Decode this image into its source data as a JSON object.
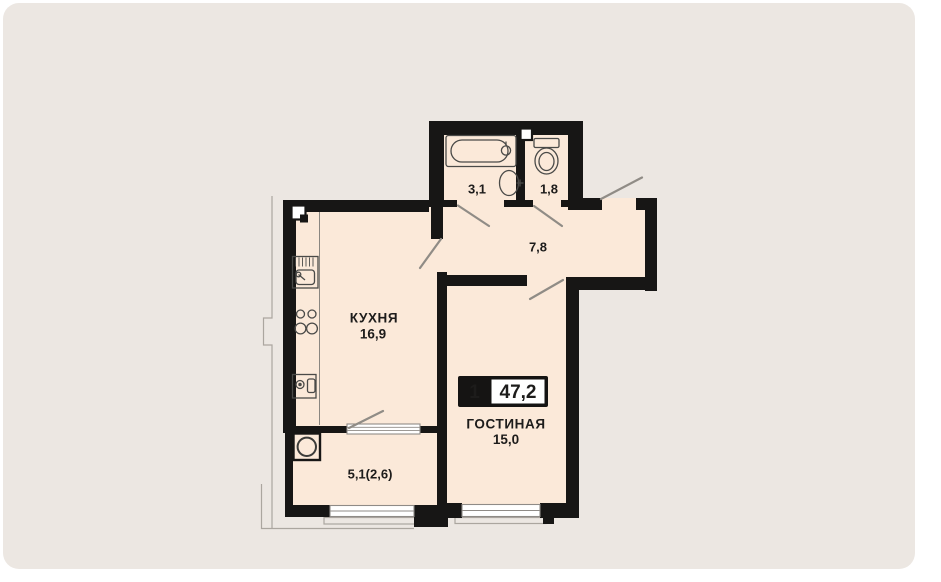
{
  "badge": {
    "rooms_count": "1",
    "total_area": "47,2"
  },
  "rooms": {
    "kitchen": {
      "name": "КУХНЯ",
      "area": "16,9"
    },
    "living": {
      "name": "ГОСТИНАЯ",
      "area": "15,0"
    },
    "hallway": {
      "area": "7,8"
    },
    "bathroom": {
      "area": "3,1"
    },
    "toilet": {
      "area": "1,8"
    },
    "balcony": {
      "area": "5,1(2,6)"
    }
  },
  "colors": {
    "page_bg": "#ffffff",
    "card_bg": "#ece7e2",
    "room_fill": "#fbe9d9",
    "wall": "#171615",
    "text": "#1d1c1b",
    "badge_bg": "#151413",
    "badge_value_bg": "#ffffff",
    "line": "#908c86"
  }
}
